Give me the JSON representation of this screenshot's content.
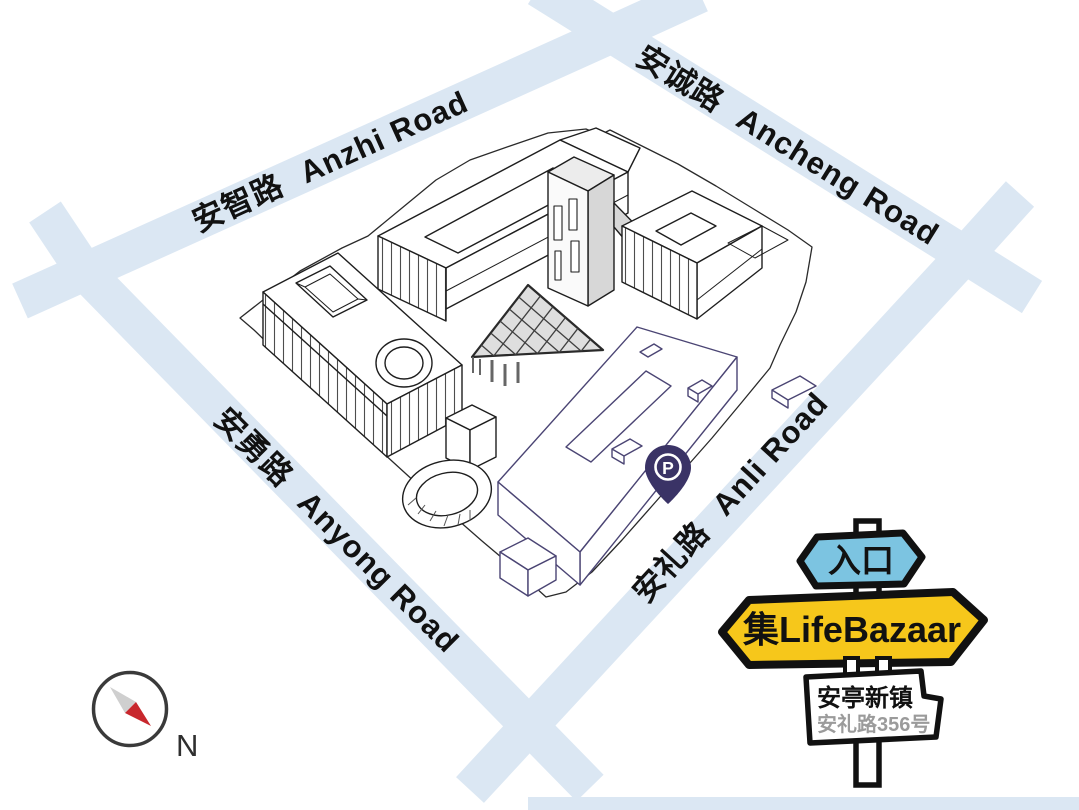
{
  "roads": [
    {
      "zh": "安智路",
      "en": "Anzhi Road"
    },
    {
      "zh": "安诚路",
      "en": "Ancheng Road"
    },
    {
      "zh": "安勇路",
      "en": "Anyong Road"
    },
    {
      "zh": "安礼路",
      "en": "Anli Road"
    }
  ],
  "parking_marker": {
    "label": "P"
  },
  "signpost": {
    "entrance_sign": "入口",
    "brand_sign": "集LifeBazaar",
    "place_name": "安亭新镇",
    "address": "安礼路356号"
  },
  "compass": {
    "north_label": "N"
  },
  "colors": {
    "road": "#dbe7f3",
    "entrance_sign_blue": "#7cc4e1",
    "brand_sign_yellow": "#f6c71b",
    "parking_pin_navy": "#3a3366",
    "building_line_black": "#1e1e1e",
    "building_line_purple": "#4b4574",
    "compass_needle_red": "#c8272d",
    "address_gray": "#9b9b9b"
  }
}
